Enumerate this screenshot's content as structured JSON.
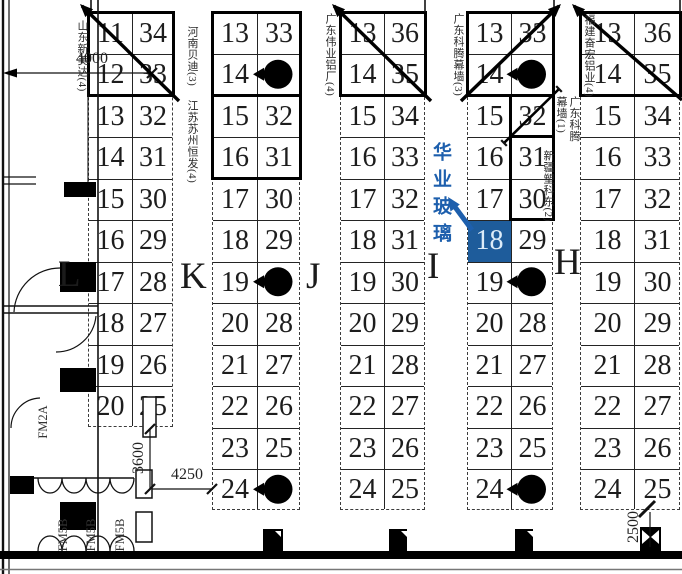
{
  "colors": {
    "highlight_bg": "#1e5c9b",
    "highlight_text": "#dcebf8",
    "callout_blue": "#1d5fad",
    "line": "#1a1a1a"
  },
  "callout": {
    "company": "华业玻璃",
    "booth": "18",
    "group": "I"
  },
  "highlight": {
    "group": "I",
    "col": "left",
    "row_index": 5,
    "booth": "18"
  },
  "groups": [
    {
      "id": "L",
      "letter": "L",
      "left": [
        "11",
        "12",
        "13",
        "14",
        "15",
        "16",
        "17",
        "18",
        "19",
        "20"
      ],
      "right": [
        "34",
        "33",
        "32",
        "31",
        "30",
        "29",
        "28",
        "27",
        "26",
        "25"
      ],
      "dots": []
    },
    {
      "id": "K",
      "letter": "K",
      "left": [
        "13",
        "14",
        "15",
        "16",
        "17",
        "18",
        "19",
        "20",
        "21",
        "22",
        "23",
        "24"
      ],
      "right": [
        "33",
        "",
        "32",
        "31",
        "30",
        "29",
        "",
        "28",
        "27",
        "26",
        "25",
        ""
      ],
      "dots": [
        1,
        6,
        11
      ]
    },
    {
      "id": "J",
      "letter": "J",
      "left": [
        "13",
        "14",
        "15",
        "16",
        "17",
        "18",
        "19",
        "20",
        "21",
        "22",
        "23",
        "24"
      ],
      "right": [
        "36",
        "35",
        "34",
        "33",
        "32",
        "31",
        "30",
        "29",
        "28",
        "27",
        "26",
        "25"
      ],
      "dots": []
    },
    {
      "id": "I",
      "letter": "I",
      "left": [
        "13",
        "14",
        "15",
        "16",
        "17",
        "18",
        "19",
        "20",
        "21",
        "22",
        "23",
        "24"
      ],
      "right": [
        "33",
        "",
        "32",
        "31",
        "30",
        "29",
        "",
        "28",
        "27",
        "26",
        "25",
        ""
      ],
      "dots": [
        1,
        6,
        11
      ]
    },
    {
      "id": "H",
      "letter": "H",
      "left": [
        "13",
        "14",
        "15",
        "16",
        "17",
        "18",
        "19",
        "20",
        "21",
        "22",
        "23",
        "24"
      ],
      "right": [
        "36",
        "35",
        "34",
        "33",
        "32",
        "31",
        "30",
        "29",
        "28",
        "27",
        "26",
        "25"
      ],
      "dots": []
    }
  ],
  "vendors": {
    "sdxmd": "山东新美达(4)",
    "hnbd": "河南贝迪(3)",
    "jssz": "江苏苏州恒发(4)",
    "gdwy": "广东伟业铝厂(4)",
    "gdkt3": "广东科腾幕墙(3)",
    "fjfh": "福建奋宏铝业(4)",
    "gdkt1": "广东科腾幕墙(1)",
    "xjsk": "新疆塑科东(2)"
  },
  "dimensions": {
    "top": "4000",
    "left_v": "3600",
    "left_h": "4250",
    "right_v": "2500"
  },
  "door_labels": {
    "fm2a": "FM2A",
    "fm5b": "FM5B"
  }
}
